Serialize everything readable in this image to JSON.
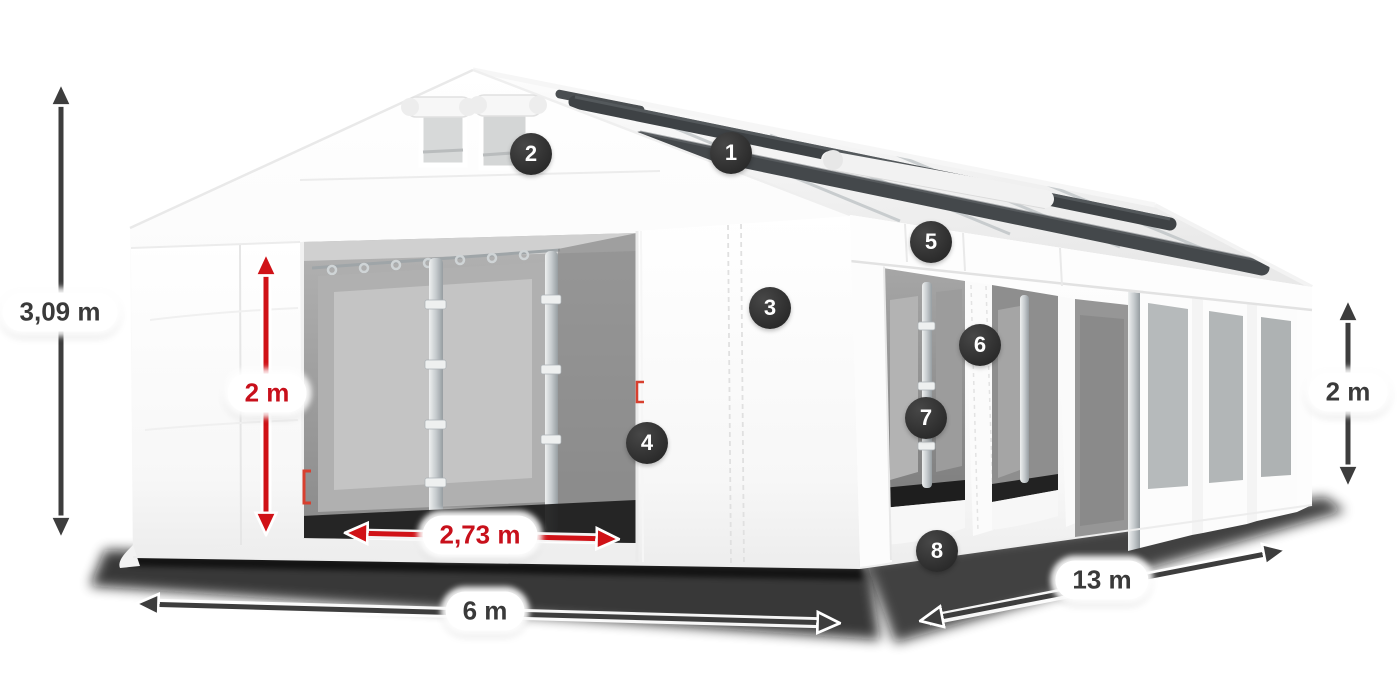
{
  "diagram": {
    "subject": "White marquee tent shown in perspective with dimension arrows and numbered feature callouts",
    "measurements": {
      "total_height": "3,09 m",
      "entrance_height": "2 m",
      "entrance_width": "2,73 m",
      "front_width": "6 m",
      "side_length": "13 m",
      "side_wall_height": "2 m"
    },
    "callouts": [
      {
        "number": "1"
      },
      {
        "number": "2"
      },
      {
        "number": "3"
      },
      {
        "number": "4"
      },
      {
        "number": "5"
      },
      {
        "number": "6"
      },
      {
        "number": "7"
      },
      {
        "number": "8"
      }
    ],
    "colors": {
      "background": "#ffffff",
      "dimension_dark": "#3d3d3d",
      "dimension_red": "#d01217",
      "red_label_text": "#c8101b",
      "dark_label_text": "#3a3a3a",
      "badge_background": "#2d2d2d",
      "badge_text": "#ffffff",
      "label_background": "#ffffff",
      "tent_fabric": "#ffffff",
      "roof_accent_dark": "#3e4245"
    }
  }
}
